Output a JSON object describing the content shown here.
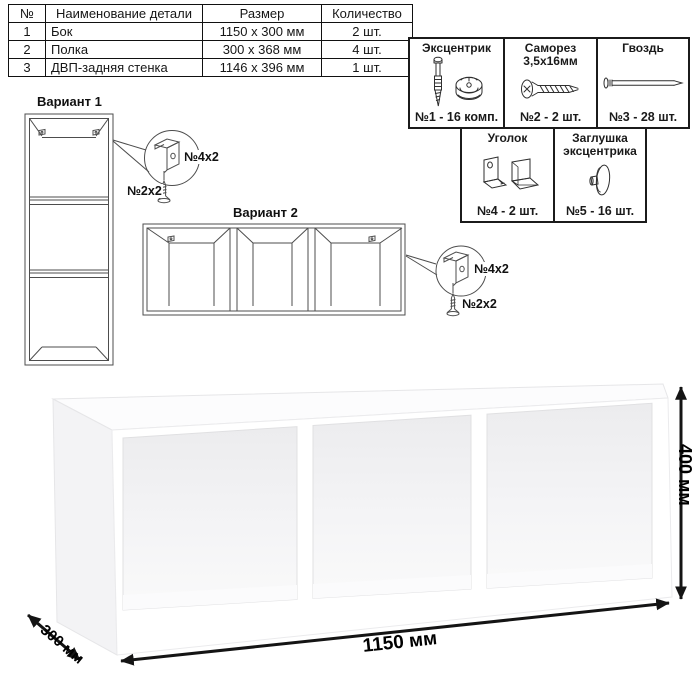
{
  "parts_table": {
    "headers": {
      "num": "№",
      "name": "Наименование детали",
      "size": "Размер",
      "qty": "Количество"
    },
    "rows": [
      {
        "num": "1",
        "name": "Бок",
        "size": "1150 x 300 мм",
        "qty": "2 шт."
      },
      {
        "num": "2",
        "name": "Полка",
        "size": "300 x 368 мм",
        "qty": "4 шт."
      },
      {
        "num": "3",
        "name": "ДВП-задняя стенка",
        "size": "1146 x 396 мм",
        "qty": "1 шт."
      }
    ]
  },
  "hardware": {
    "items": [
      {
        "icon": "eccentric-cam-icon",
        "title": "Эксцентрик",
        "count": "№1 - 16 комп."
      },
      {
        "icon": "screw-icon",
        "title": "Саморез\n3,5х16мм",
        "count": "№2 - 2 шт."
      },
      {
        "icon": "nail-icon",
        "title": "Гвоздь",
        "count": "№3 - 28 шт."
      },
      {
        "icon": "corner-bracket-icon",
        "title": "Уголок",
        "count": "№4 - 2 шт."
      },
      {
        "icon": "cam-cap-icon",
        "title": "Заглушка\nэксцентрика",
        "count": "№5 - 16 шт."
      }
    ]
  },
  "variants": {
    "v1": {
      "title": "Вариант 1",
      "bracket_label": "№4х2",
      "screw_label": "№2х2"
    },
    "v2": {
      "title": "Вариант 2",
      "bracket_label": "№4х2",
      "screw_label": "№2х2"
    }
  },
  "dimensions": {
    "width": "1150 мм",
    "depth": "300 мм",
    "height": "400 мм"
  },
  "colors": {
    "line_art": "#4d4d4d",
    "table_border": "#111111",
    "arrow": "#141414",
    "background": "#ffffff"
  }
}
